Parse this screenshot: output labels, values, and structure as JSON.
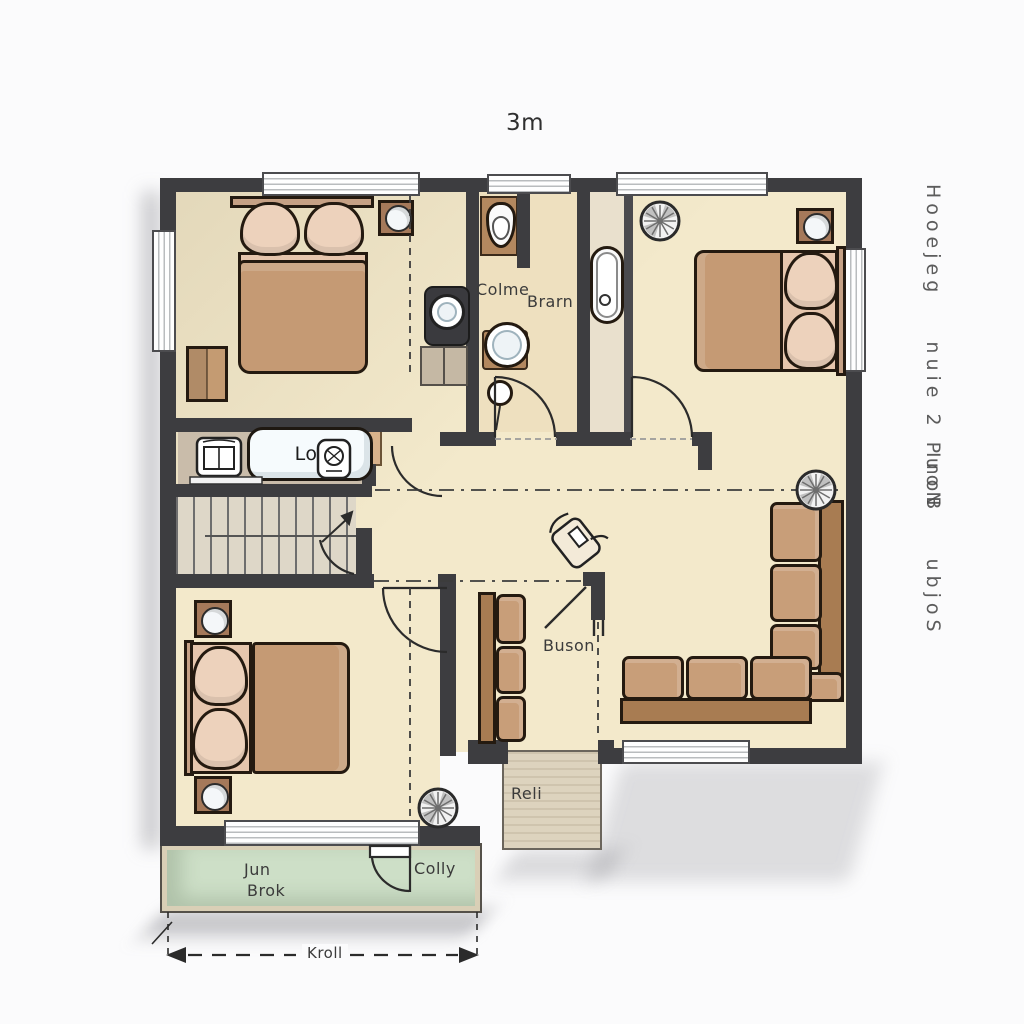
{
  "drawing_type": "floor_plan",
  "annotations": {
    "scale": "3m",
    "dimension": "Kroll",
    "side_note_1": "Hooejeg    nuie 2 PuoN",
    "side_note_2": "InoB    ubjoS"
  },
  "rooms": {
    "bathroom": "Colme",
    "bathroom2": "Brarn",
    "island": "Lot",
    "living": "Buson",
    "entry": "Reli",
    "balcony_line1": "Jun",
    "balcony_line2": "Brok",
    "balcony_right": "Colly"
  },
  "colors": {
    "wall": "#3d3d40",
    "floor": "#f3e9cb",
    "balcony": "#cddfc7",
    "porch": "#ddd3be",
    "counter": "#c9bcaa",
    "sofa": "#c89e79",
    "blanket": "#c59a74",
    "pillow": "#edd2bc",
    "wood": "#a5795a",
    "stairs": "#ded7c8"
  }
}
